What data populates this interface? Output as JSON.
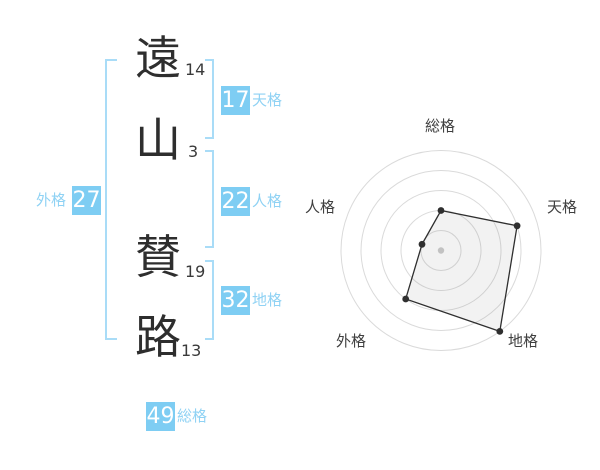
{
  "name": {
    "characters": [
      {
        "char": "遠",
        "strokes": "14"
      },
      {
        "char": "山",
        "strokes": "3"
      },
      {
        "char": "賛",
        "strokes": "19"
      },
      {
        "char": "路",
        "strokes": "13"
      }
    ]
  },
  "kaku": {
    "tenkaku": {
      "label": "天格",
      "value": "17"
    },
    "jinkaku": {
      "label": "人格",
      "value": "22"
    },
    "chikaku": {
      "label": "地格",
      "value": "32"
    },
    "gaikaku": {
      "label": "外格",
      "value": "27"
    },
    "soukaku": {
      "label": "総格",
      "value": "49"
    }
  },
  "chart_data": {
    "type": "radar",
    "categories": [
      "総格",
      "天格",
      "地格",
      "外格",
      "人格"
    ],
    "values": [
      40,
      80,
      100,
      60,
      20
    ],
    "max": 100,
    "rings": 5,
    "ring_step": 20,
    "start_angle_deg": 90,
    "direction": "clockwise",
    "grid": "concentric-circles",
    "legend": "none",
    "title": ""
  },
  "colors": {
    "badge_bg": "#7ECDF3",
    "badge_text": "#FFFFFF",
    "kaku_label": "#8FD2F4",
    "bracket": "#A9DCF7",
    "name_text": "#2E2E2E",
    "stroke_count": "#3A3A3A",
    "radar_ring": "#DADADA",
    "radar_line": "#2F2F2F",
    "radar_fill": "rgba(130,130,130,0.10)",
    "radar_center_dot": "#C2C2C2",
    "radar_label": "#3F3F3F"
  }
}
